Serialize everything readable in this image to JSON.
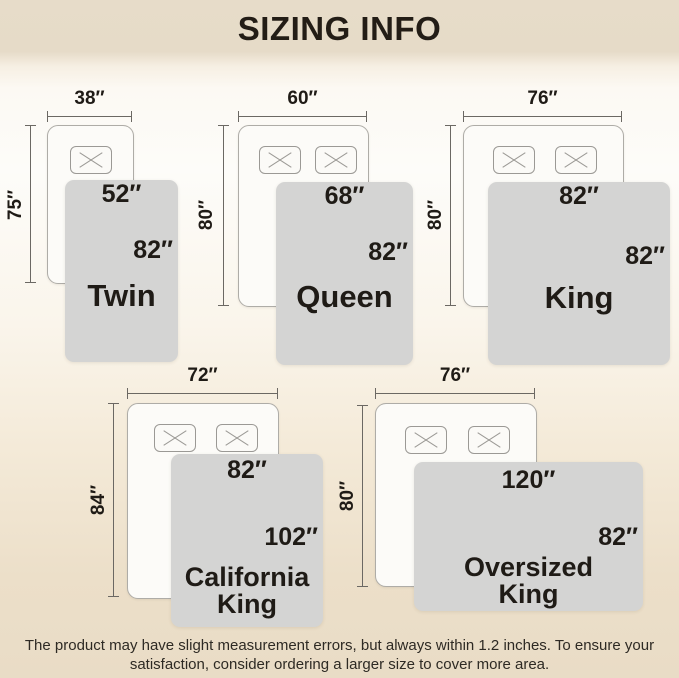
{
  "title": "SIZING INFO",
  "colors": {
    "header_bg": "#e6dbc8",
    "background_bottom": "#e9dcc6",
    "blanket": "#d4d4d3",
    "bed_fill": "#fcfbf8",
    "dimension_line": "#6b6863",
    "text": "#1f1b16"
  },
  "sizes": [
    {
      "name": "Twin",
      "bed_width": "38″",
      "bed_length": "75″",
      "blanket_width": "52″",
      "blanket_length": "82″",
      "pillows": 1
    },
    {
      "name": "Queen",
      "bed_width": "60″",
      "bed_length": "80″",
      "blanket_width": "68″",
      "blanket_length": "82″",
      "pillows": 2
    },
    {
      "name": "King",
      "bed_width": "76″",
      "bed_length": "80″",
      "blanket_width": "82″",
      "blanket_length": "82″",
      "pillows": 2
    },
    {
      "name": "California\nKing",
      "bed_width": "72″",
      "bed_length": "84″",
      "blanket_width": "82″",
      "blanket_length": "102″",
      "pillows": 2
    },
    {
      "name": "Oversized\nKing",
      "bed_width": "76″",
      "bed_length": "80″",
      "blanket_width": "120″",
      "blanket_length": "82″",
      "pillows": 2
    }
  ],
  "footer": {
    "line1": "The product may have slight measurement errors, but always within 1.2 inches. To ensure your",
    "line2": "satisfaction, consider ordering a larger size to cover more area."
  }
}
